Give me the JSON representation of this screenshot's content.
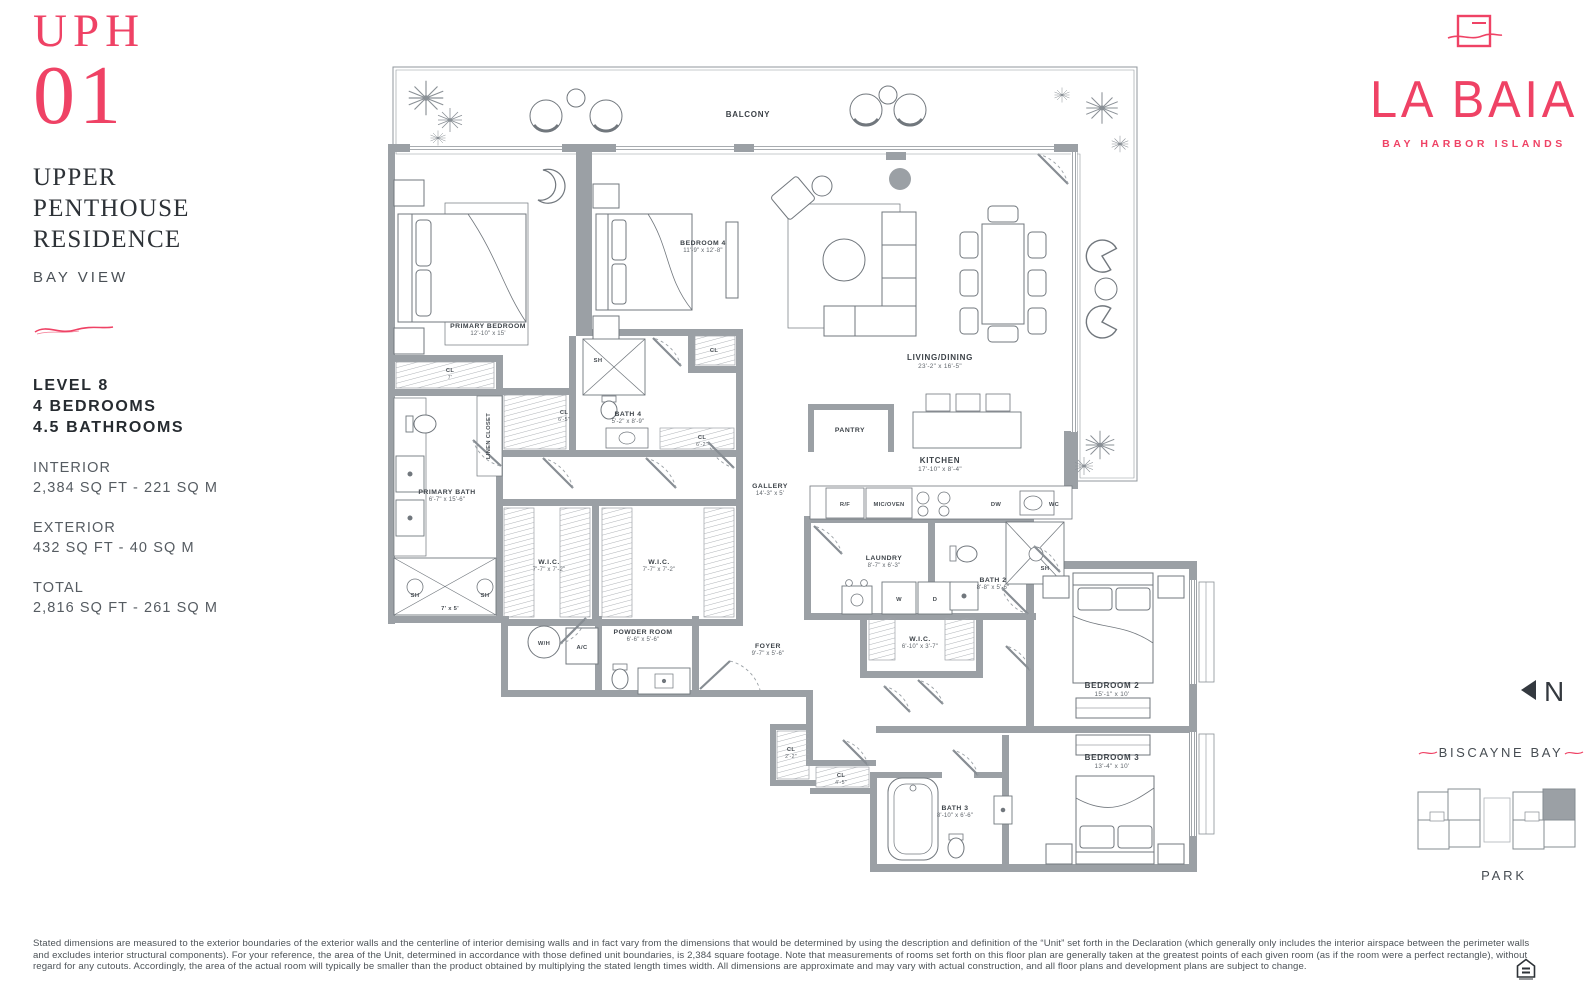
{
  "colors": {
    "brand_pink": "#EF4265",
    "wall_gray": "#9BA0A5",
    "line_gray": "#71777D",
    "ink": "#2D3237"
  },
  "header": {
    "unit_label": "UPH",
    "unit_number": "01",
    "title": [
      "UPPER",
      "PENTHOUSE",
      "RESIDENCE"
    ],
    "view": "BAY VIEW"
  },
  "facts": {
    "level": "LEVEL 8",
    "bedrooms": "4 BEDROOMS",
    "bathrooms": "4.5 BATHROOMS",
    "interior_label": "INTERIOR",
    "interior_value": "2,384 SQ FT - 221 SQ M",
    "exterior_label": "EXTERIOR",
    "exterior_value": "432 SQ FT - 40 SQ M",
    "total_label": "TOTAL",
    "total_value": "2,816 SQ FT - 261 SQ M"
  },
  "brand": {
    "name": "LA BAIA",
    "tagline": "BAY HARBOR ISLANDS"
  },
  "compass": {
    "north": "N"
  },
  "keyplan": {
    "water": "BISCAYNE BAY",
    "park": "PARK"
  },
  "plan": {
    "labels": [
      {
        "n": "BALCONY",
        "x": 750,
        "y": 119,
        "s": "b"
      },
      {
        "n": "PRIMARY BEDROOM",
        "d": "12'-10\" x 15'",
        "x": 490,
        "y": 330,
        "s": "s"
      },
      {
        "n": "BEDROOM 4",
        "d": "11'-9\" x 12'-8\"",
        "x": 705,
        "y": 247,
        "s": "s"
      },
      {
        "n": "LIVING/DINING",
        "d": "23'-2\" x 16'-5\"",
        "x": 942,
        "y": 362,
        "s": "b"
      },
      {
        "n": "KITCHEN",
        "d": "17'-10\" x 8'-4\"",
        "x": 942,
        "y": 465,
        "s": "b"
      },
      {
        "n": "GALLERY",
        "d": "14'-3\" x 5'",
        "x": 772,
        "y": 490,
        "s": "s"
      },
      {
        "n": "PANTRY",
        "x": 852,
        "y": 434,
        "s": "s"
      },
      {
        "n": "PRIMARY BATH",
        "d": "6'-7\" x 15'-6\"",
        "x": 449,
        "y": 496,
        "s": "s"
      },
      {
        "n": "BATH 4",
        "d": "5'-2\" x 8'-9\"",
        "x": 630,
        "y": 418,
        "s": "s"
      },
      {
        "n": "LAUNDRY",
        "d": "8'-7\" x 6'-3\"",
        "x": 886,
        "y": 562,
        "s": "s"
      },
      {
        "n": "BATH 2",
        "d": "8'-8\" x 5'-6\"",
        "x": 995,
        "y": 584,
        "s": "s"
      },
      {
        "n": "W.I.C.",
        "d": "7'-7\" x 7'-2\"",
        "x": 551,
        "y": 566,
        "s": "s"
      },
      {
        "n": "W.I.C.",
        "d": "7'-7\" x 7'-2\"",
        "x": 661,
        "y": 566,
        "s": "s"
      },
      {
        "n": "W.I.C.",
        "d": "6'-10\" x 3'-7\"",
        "x": 922,
        "y": 643,
        "s": "s"
      },
      {
        "n": "POWDER ROOM",
        "d": "6'-6\" x 5'-6\"",
        "x": 645,
        "y": 636,
        "s": "s"
      },
      {
        "n": "FOYER",
        "d": "9'-7\" x 5'-6\"",
        "x": 770,
        "y": 650,
        "s": "s"
      },
      {
        "n": "BEDROOM 2",
        "d": "15'-1\" x 10'",
        "x": 1114,
        "y": 690,
        "s": "b"
      },
      {
        "n": "BEDROOM 3",
        "d": "13'-4\" x 10'",
        "x": 1114,
        "y": 762,
        "s": "b"
      },
      {
        "n": "BATH 3",
        "d": "8'-10\" x 6'-6\"",
        "x": 957,
        "y": 812,
        "s": "s"
      },
      {
        "n": "CL",
        "d": "7'",
        "x": 452,
        "y": 374,
        "s": "t"
      },
      {
        "n": "CL",
        "d": "6'-5\"",
        "x": 566,
        "y": 416,
        "s": "t"
      },
      {
        "n": "CL",
        "x": 716,
        "y": 354,
        "s": "t"
      },
      {
        "n": "CL",
        "d": "6'-2\"",
        "x": 704,
        "y": 441,
        "s": "t"
      },
      {
        "n": "CL",
        "d": "2'-2\"",
        "x": 793,
        "y": 753,
        "s": "t"
      },
      {
        "n": "CL",
        "d": "4'-5\"",
        "x": 843,
        "y": 779,
        "s": "t"
      },
      {
        "n": "LINEN CLOSET",
        "x": 492,
        "y": 438,
        "s": "t",
        "r": -90
      },
      {
        "n": "SH",
        "x": 600,
        "y": 364,
        "s": "t"
      },
      {
        "n": "SH",
        "x": 417,
        "y": 599,
        "s": "t"
      },
      {
        "n": "SH",
        "x": 487,
        "y": 599,
        "s": "t"
      },
      {
        "n": "7' x 5'",
        "x": 452,
        "y": 612,
        "s": "t"
      },
      {
        "n": "SH",
        "x": 1047,
        "y": 572,
        "s": "t"
      },
      {
        "n": "W/H",
        "x": 546,
        "y": 647,
        "s": "t"
      },
      {
        "n": "A/C",
        "x": 584,
        "y": 651,
        "s": "t"
      },
      {
        "n": "R/F",
        "x": 847,
        "y": 508,
        "s": "t"
      },
      {
        "n": "MIC/OVEN",
        "x": 891,
        "y": 508,
        "s": "t"
      },
      {
        "n": "DW",
        "x": 998,
        "y": 508,
        "s": "t"
      },
      {
        "n": "WC",
        "x": 1056,
        "y": 508,
        "s": "t"
      },
      {
        "n": "W",
        "x": 901,
        "y": 603,
        "s": "t"
      },
      {
        "n": "D",
        "x": 937,
        "y": 603,
        "s": "t"
      }
    ]
  },
  "disclaimer": "Stated dimensions are measured to the exterior boundaries of the exterior walls and the centerline of interior demising walls and in fact vary from the dimensions that would be determined by using the description and definition of the “Unit” set forth in the Declaration (which generally only includes the interior airspace between the perimeter walls and excludes interior structural components).  For your reference, the area of the Unit, determined in accordance with those defined unit boundaries, is 2,384 square footage. Note that measurements of rooms set forth on this floor plan are generally taken at the greatest points of each given room (as if the room were a perfect rectangle), without regard for any cutouts. Accordingly, the area of the actual room will typically be smaller than the product obtained by multiplying the stated length times width. All dimensions are approximate and may vary with actual construction, and all floor plans and development plans are subject to change."
}
